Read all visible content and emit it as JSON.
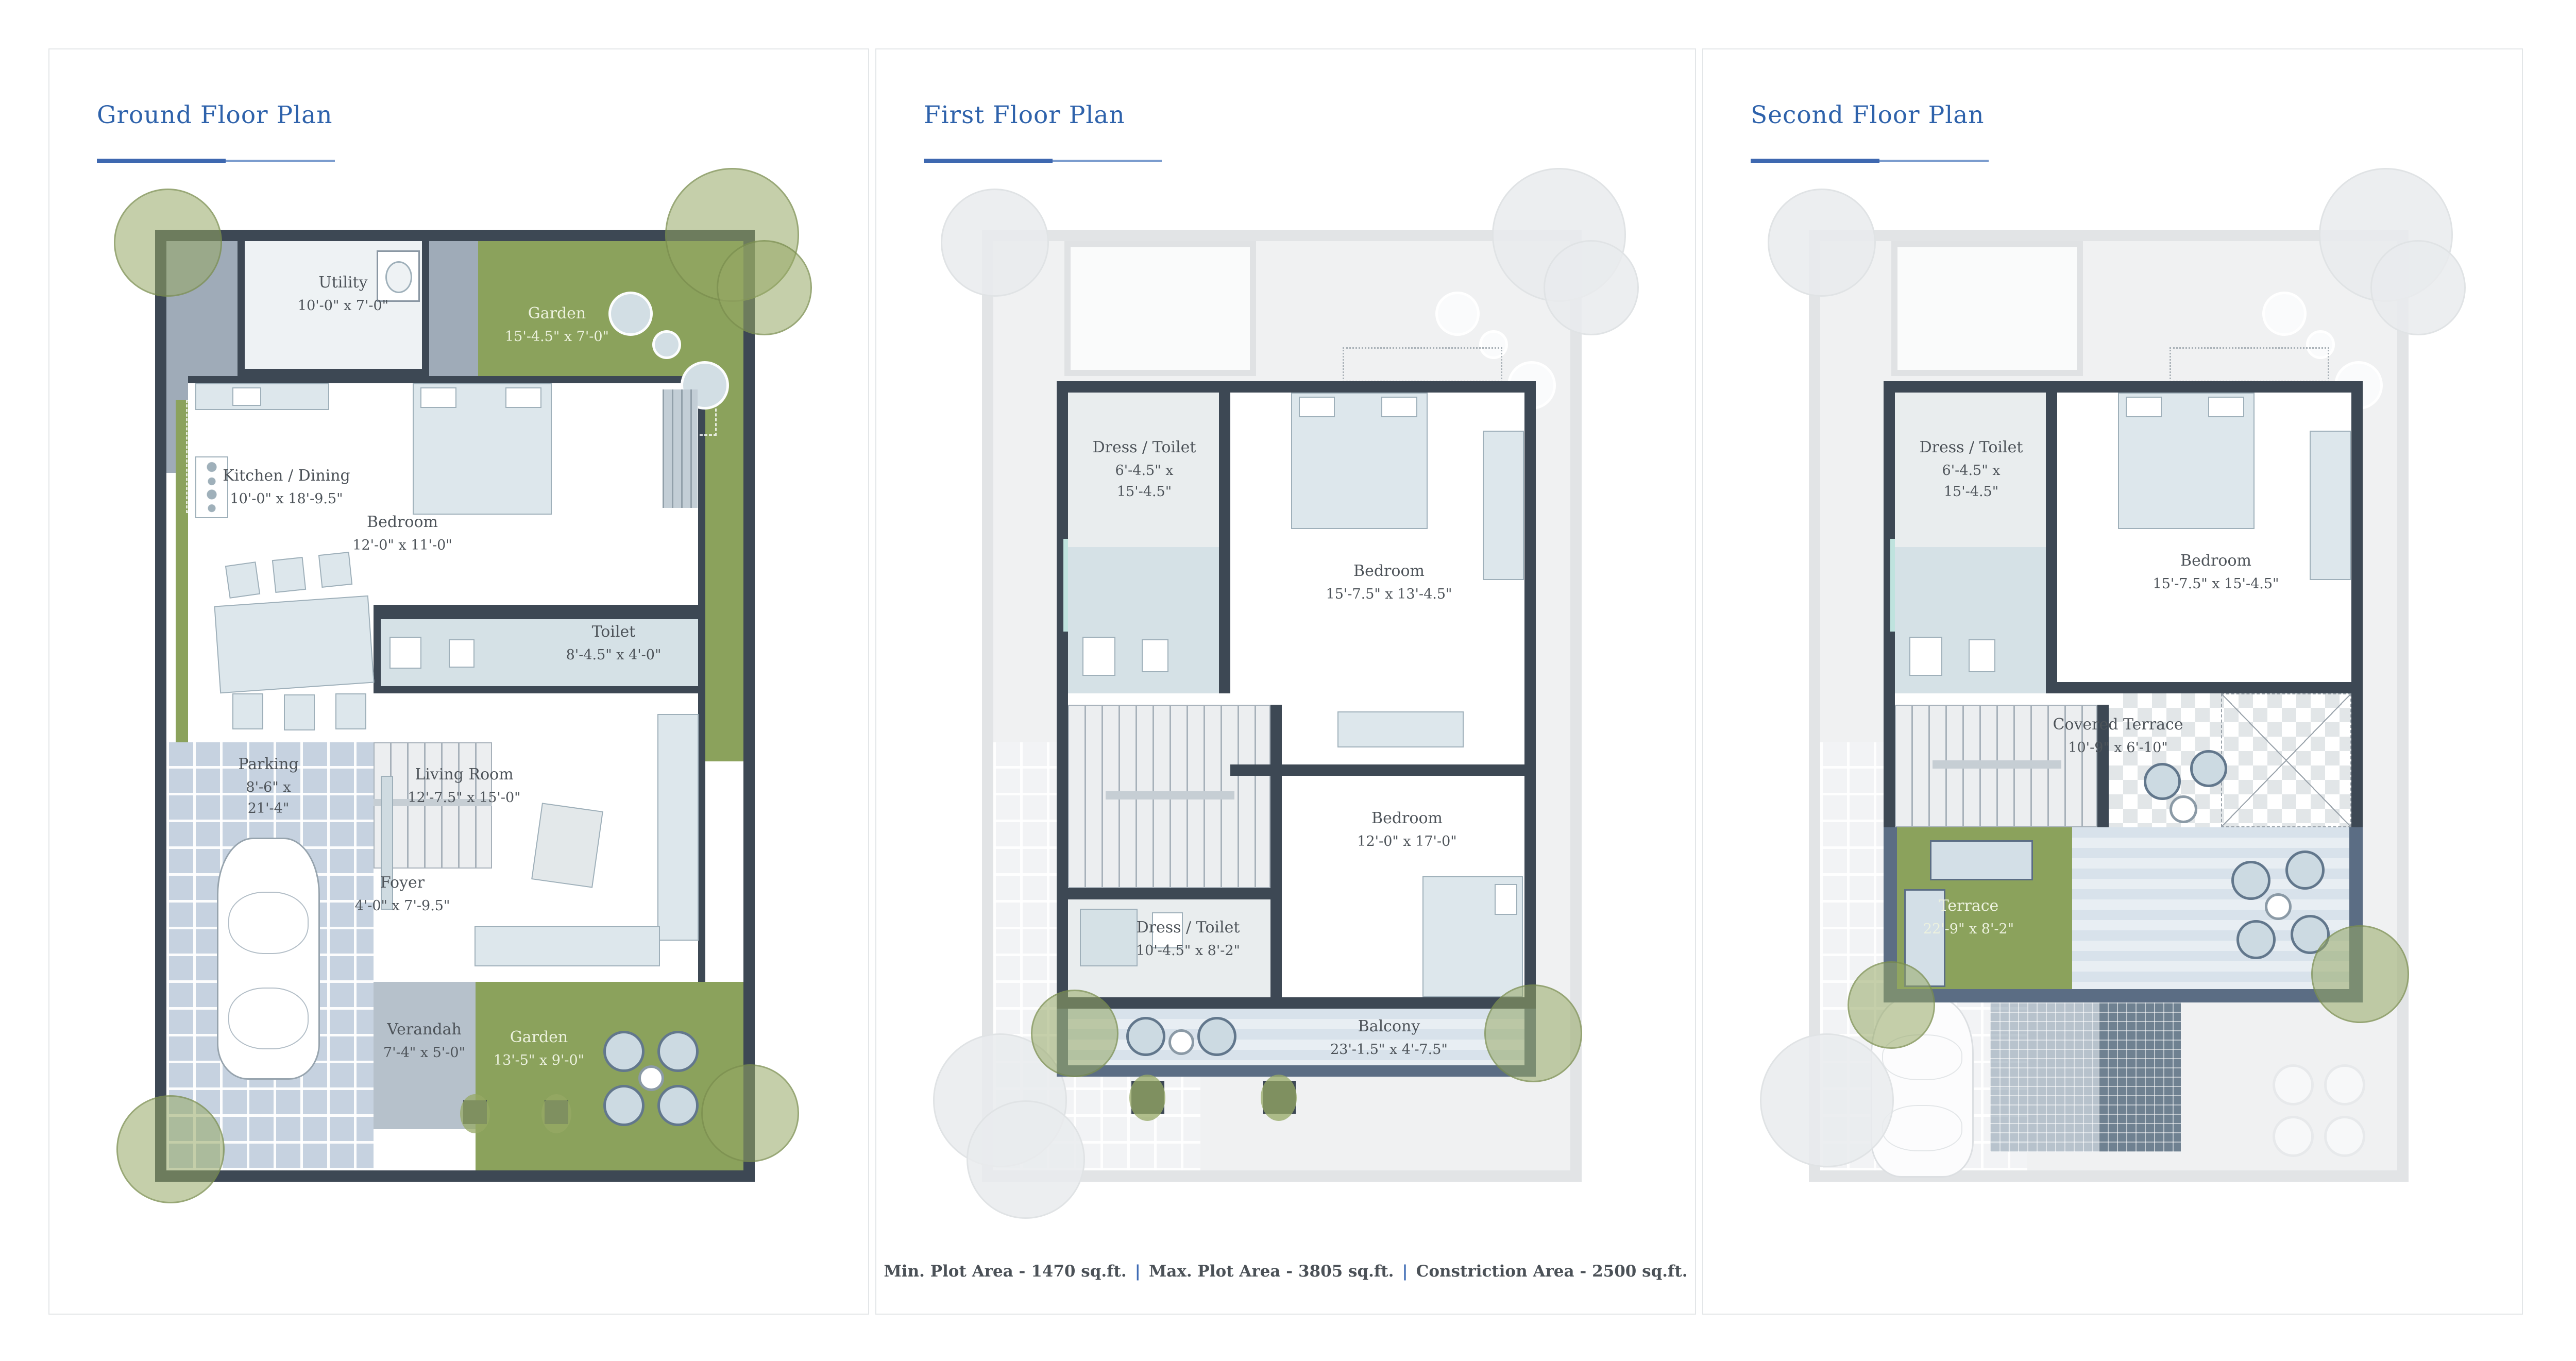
{
  "floors": [
    {
      "title": "Ground Floor Plan",
      "rooms": [
        {
          "name": "Utility",
          "dims": [
            "10'-0\" x 7'-0\""
          ]
        },
        {
          "name": "Garden",
          "dims": [
            "15'-4.5\" x 7'-0\""
          ]
        },
        {
          "name": "Kitchen / Dining",
          "dims": [
            "10'-0\" x 18'-9.5\""
          ]
        },
        {
          "name": "Bedroom",
          "dims": [
            "12'-0\" x 11'-0\""
          ]
        },
        {
          "name": "Toilet",
          "dims": [
            "8'-4.5\" x 4'-0\""
          ]
        },
        {
          "name": "Living Room",
          "dims": [
            "12'-7.5\" x 15'-0\""
          ]
        },
        {
          "name": "Foyer",
          "dims": [
            "4'-0\" x 7'-9.5\""
          ]
        },
        {
          "name": "Parking",
          "dims": [
            "8'-6\" x",
            "21'-4\""
          ]
        },
        {
          "name": "Verandah",
          "dims": [
            "7'-4\" x 5'-0\""
          ]
        },
        {
          "name": "Garden",
          "dims": [
            "13'-5\" x 9'-0\""
          ]
        }
      ]
    },
    {
      "title": "First Floor Plan",
      "rooms": [
        {
          "name": "Dress / Toilet",
          "dims": [
            "6'-4.5\" x",
            "15'-4.5\""
          ]
        },
        {
          "name": "Bedroom",
          "dims": [
            "15'-7.5\" x 13'-4.5\""
          ]
        },
        {
          "name": "Bedroom",
          "dims": [
            "12'-0\" x 17'-0\""
          ]
        },
        {
          "name": "Dress / Toilet",
          "dims": [
            "10'-4.5\" x 8'-2\""
          ]
        },
        {
          "name": "Balcony",
          "dims": [
            "23'-1.5\" x 4'-7.5\""
          ]
        }
      ]
    },
    {
      "title": "Second Floor Plan",
      "rooms": [
        {
          "name": "Dress / Toilet",
          "dims": [
            "6'-4.5\" x",
            "15'-4.5\""
          ]
        },
        {
          "name": "Bedroom",
          "dims": [
            "15'-7.5\" x 15'-4.5\""
          ]
        },
        {
          "name": "Covered Terrace",
          "dims": [
            "10'-9\" x 6'-10\""
          ]
        },
        {
          "name": "Terrace",
          "dims": [
            "22'-9\" x 8'-2\""
          ]
        }
      ]
    }
  ],
  "footnote": {
    "min_plot": "Min. Plot Area - 1470 sq.ft.",
    "max_plot": "Max. Plot Area - 3805 sq.ft.",
    "construction": "Constriction Area - 2500 sq.ft.",
    "separator": "|"
  },
  "colors": {
    "title_blue": "#2e62ab",
    "wall_slate": "#3d4854",
    "garden_green": "#8ba25c",
    "balcony_slate": "#5b6d84",
    "walkway_gray": "#9fabb8",
    "parking_tile": "#c6d2e0",
    "bath_teal": "#d5e1e6"
  }
}
